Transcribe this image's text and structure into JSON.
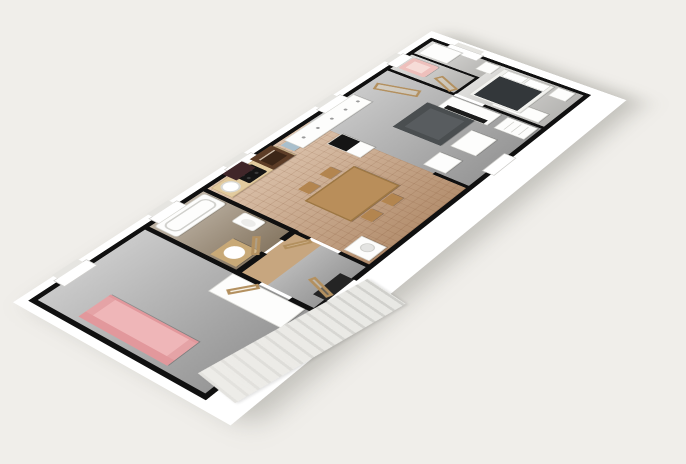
{
  "scene": {
    "type": "3d-floorplan-perspective-render",
    "description": "Elongated apartment viewed from above at an angle; no visible text or UI chrome"
  },
  "palette": {
    "background": "#f0eeea",
    "slab_white": "#ffffff",
    "wall_black": "#101010",
    "floor_gray": "#a9a9a9",
    "floor_gray_light": "#c9c8c5",
    "floor_bedroom": "#cbcac7",
    "floor_tile_terracotta": "#c9a07c",
    "floor_bath_brown": "#97866f",
    "floor_hall_wood": "#c7a67f",
    "wood_door_tan": "#c8a977",
    "counter_wood": "#e2cb9f",
    "table_wood": "#b98e5a",
    "chair_wood": "#b3854f",
    "sofa_pink": "#e2989c",
    "sofa_pink_seat": "#efb6b8",
    "armchair_pink": "#eec0bc",
    "sofa_dark": "#4a4e50",
    "sofa_dark_seat": "#585c5f",
    "bed_duvet": "#33373a",
    "oven_brown": "#5d3d27",
    "hood_dark": "#402629",
    "cooktop_black": "#151515",
    "fridge_top_black": "#151515",
    "tv_black": "#1b1b1b",
    "dish_blue": "#a9bfcc",
    "threshold_dark": "#242424",
    "stairs_gray": "#dcdcd8"
  },
  "rooms": [
    {
      "name": "living-room-west",
      "floor": "gray"
    },
    {
      "name": "bathroom",
      "floor": "brown"
    },
    {
      "name": "hallway",
      "floor": "gray-wood"
    },
    {
      "name": "kitchen-dining",
      "floor": "terracotta-tile"
    },
    {
      "name": "living-room-center",
      "floor": "gray"
    },
    {
      "name": "small-room-armchair",
      "floor": "light-gray"
    },
    {
      "name": "bedroom-east",
      "floor": "light-gray"
    }
  ],
  "furniture": [
    "pink-sofa",
    "wardrobe-west",
    "bathtub",
    "toilet",
    "vanity-sink",
    "kitchen-counter",
    "kitchen-sink",
    "cooktop",
    "range-hood",
    "oven",
    "dish-stack",
    "washing-machine",
    "dining-table",
    "dining-chairs",
    "fridge",
    "sideboard-cabinets",
    "dark-sofa",
    "coffee-table",
    "small-table",
    "tv",
    "tv-stand",
    "drawer-dresser",
    "pink-armchair",
    "bed",
    "pillows",
    "nightstand-north",
    "nightstand-south",
    "wardrobe-bedroom-north",
    "wardrobe-bedroom-west",
    "open-doors-wood",
    "windows",
    "exterior-staircase"
  ]
}
